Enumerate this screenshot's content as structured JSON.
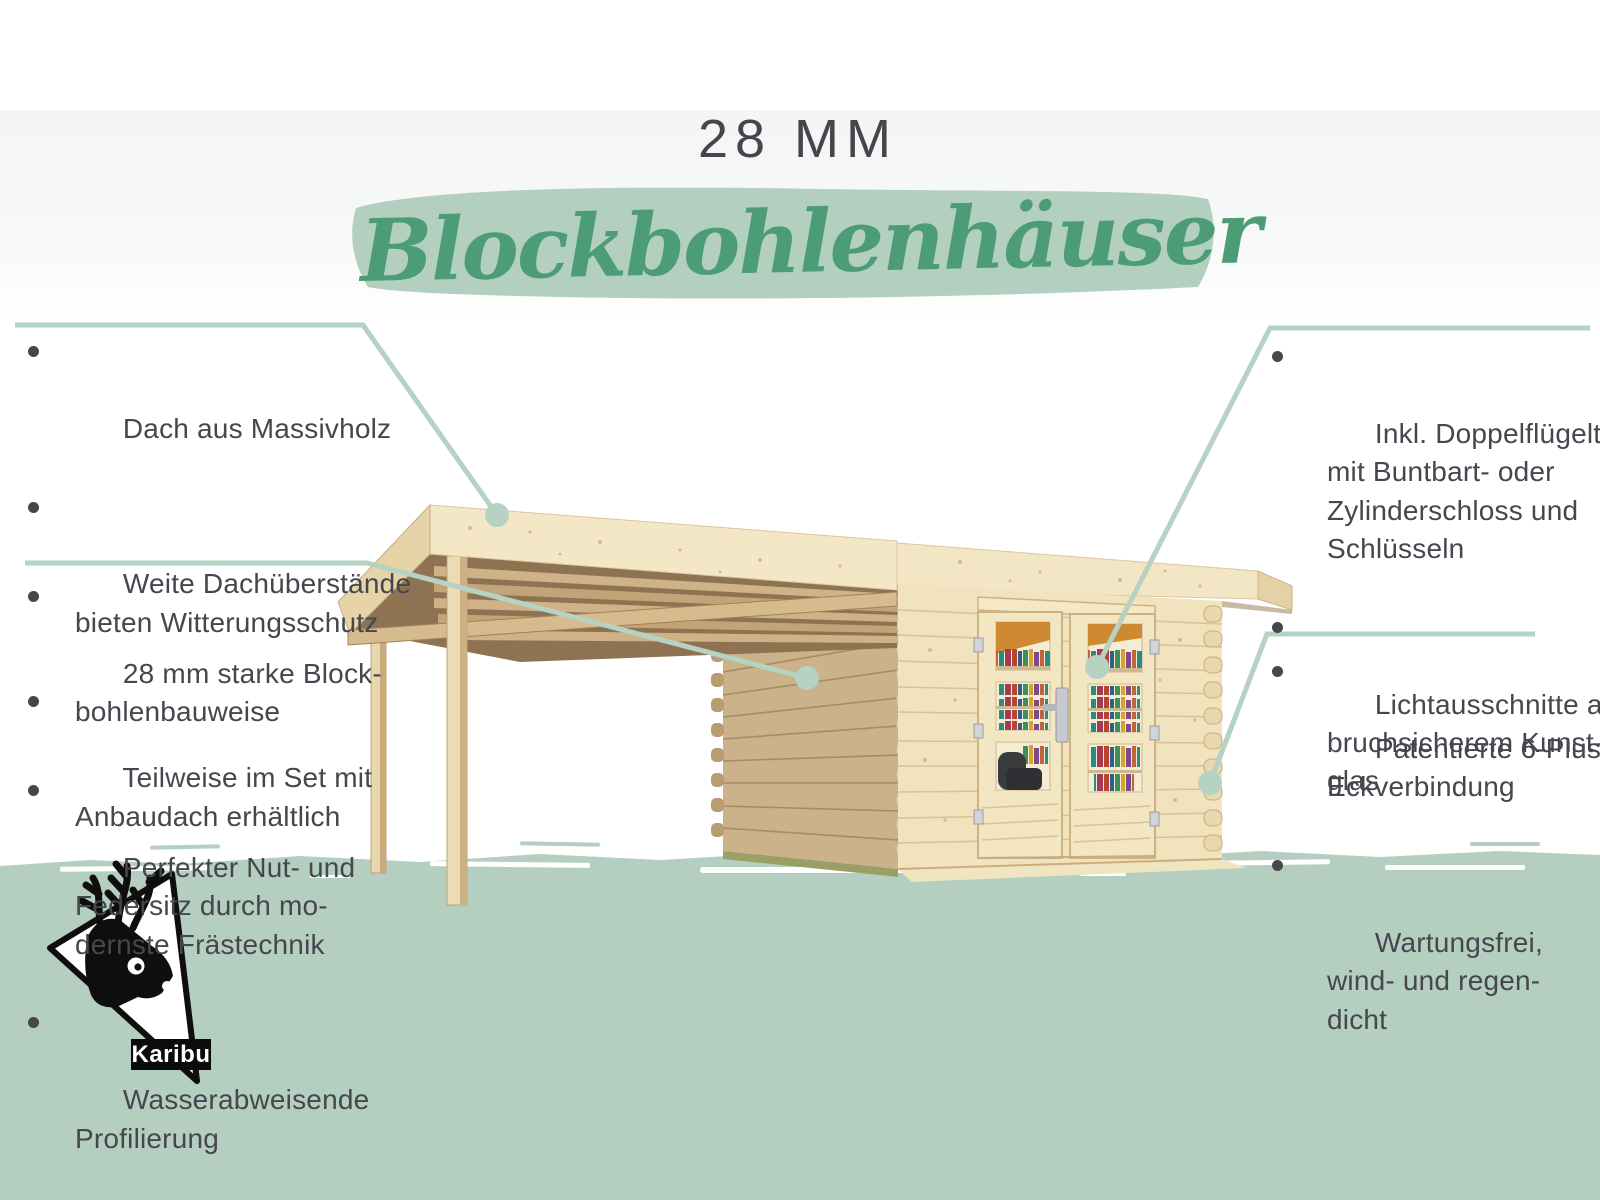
{
  "title": {
    "size_label": "28 MM",
    "heading": "Blockbohlenhäuser"
  },
  "callouts": {
    "left_top": {
      "items": [
        "Dach aus Massivholz",
        "Weite Dachüberstände\nbieten Witterungsschutz",
        "Teilweise im Set mit\nAnbaudach erhältlich"
      ]
    },
    "left_bottom": {
      "items": [
        "28 mm starke Block-\nbohlenbauweise",
        "Perfekter Nut- und\nFedersitz durch mo-\ndernste Frästechnik",
        "Wasserabweisende\nProfilierung"
      ]
    },
    "right_top": {
      "items": [
        "Inkl. Doppelflügeltür\nmit Buntbart- oder\nZylinderschloss und\nSchlüsseln",
        "Lichtausschnitte aus\nbruchsicherem Kunst-\nglas"
      ]
    },
    "right_bottom": {
      "items": [
        "Patentierte 6-Plus-\nEckverbindung",
        "Wartungsfrei,\nwind- und regen-\ndicht"
      ]
    }
  },
  "logo": {
    "brand": "Karibu",
    "mark": "caribou-head-icon"
  },
  "colors": {
    "accent_green": "#4c9c76",
    "sage_band": "#b4cec0",
    "callout_green": "#b5d2c2",
    "text_dark": "#46464e",
    "wood_light": "#f2e5c2",
    "wood_shaded": "#cbb28a"
  }
}
